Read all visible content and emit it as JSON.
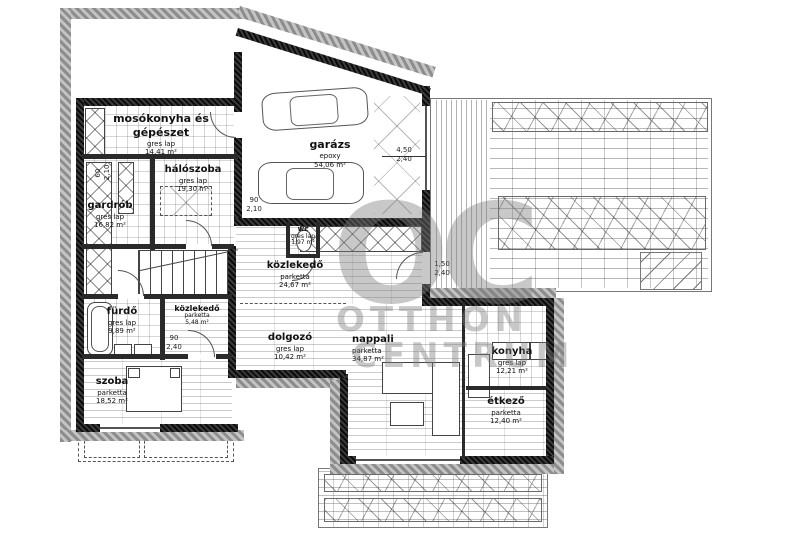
{
  "watermark": {
    "logo": "OC",
    "line1": "OTTHON",
    "line2": "CENTRUM"
  },
  "rooms": {
    "mosokonyha": {
      "name": "mosókonyha és gépészet",
      "material": "gres lap",
      "area": "14,41 m²"
    },
    "haloszoba": {
      "name": "hálószoba",
      "material": "gres lap",
      "area": "19,30 m²"
    },
    "gardrob": {
      "name": "gardrób",
      "material": "gres lap",
      "area": "16,82 m²"
    },
    "garazs": {
      "name": "garázs",
      "material": "epoxy",
      "area": "54,06 m²"
    },
    "wc": {
      "name": "wc",
      "material": "gres lap",
      "area": "1,97 m²"
    },
    "kozlekedo_central": {
      "name": "közlekedő",
      "material": "parketta",
      "area": "24,67 m²"
    },
    "furdo": {
      "name": "fürdő",
      "material": "gres lap",
      "area": "9,89 m²"
    },
    "kozlekedo_small": {
      "name": "közlekedő",
      "material": "parketta",
      "area": "5,48 m²"
    },
    "szoba": {
      "name": "szoba",
      "material": "parketta",
      "area": "18,52 m²"
    },
    "dolgozo": {
      "name": "dolgozó",
      "material": "gres lap",
      "area": "10,42 m²"
    },
    "nappali": {
      "name": "nappali",
      "material": "parketta",
      "area": "34,87 m²"
    },
    "konyha": {
      "name": "konyha",
      "material": "gres lap",
      "area": "12,21 m²"
    },
    "etkezo": {
      "name": "étkező",
      "material": "parketta",
      "area": "12,40 m²"
    }
  },
  "dimensions": {
    "garage_opening": {
      "w": "4,50",
      "h": "2,40"
    },
    "hall_terrace_door": {
      "w": "1,50",
      "h": "2,40"
    },
    "bedroom_door": {
      "w": "90",
      "h": "2,10"
    },
    "bath_door": {
      "w": "90",
      "h": "2,40"
    },
    "wardrobe_niche": {
      "w": "60",
      "h": "2,10"
    }
  },
  "colors": {
    "wall": "#1a1a1a",
    "outline_gray": "#a0a0a0",
    "watermark_gray": "#9a9a9a",
    "paper": "#ffffff"
  }
}
